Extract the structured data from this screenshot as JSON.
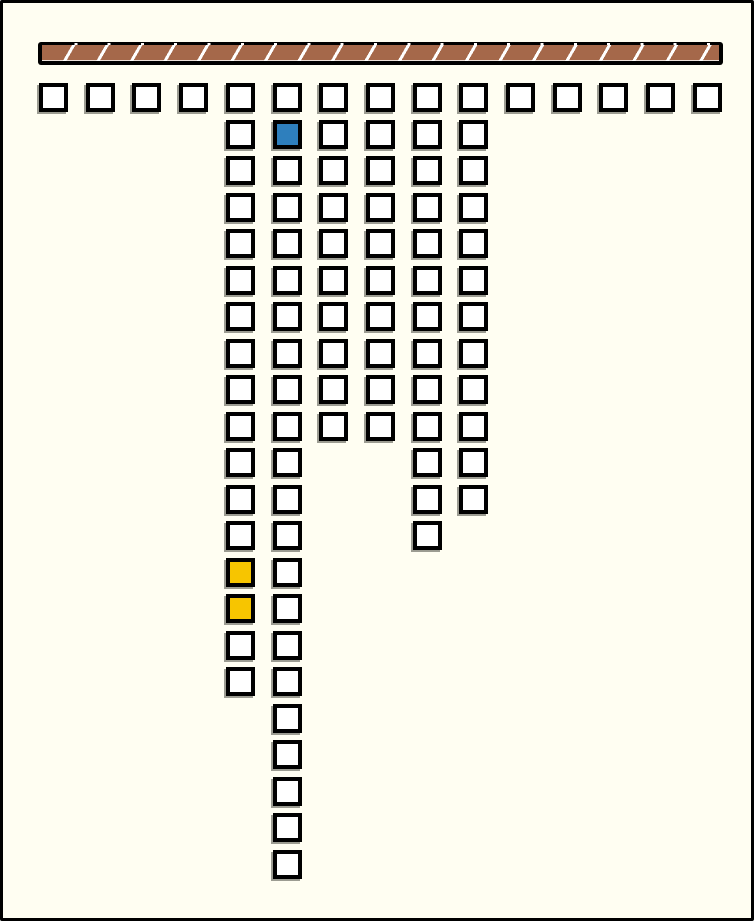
{
  "window": {
    "width": 754,
    "height": 921,
    "background_color": "#FFFEF2",
    "frame_color": "#000000"
  },
  "beam": {
    "x": 35,
    "y": 39,
    "width": 685,
    "height": 23,
    "fill_color": "#A5684A",
    "frame_color": "#000000",
    "stripe_color": "#FFFFFF",
    "stripe_pitch_px": 33.3,
    "stripe_angle_deg": 120
  },
  "board": {
    "origin_x": 36,
    "origin_y": 80,
    "col_pitch": 46.7,
    "row_pitch": 36.5,
    "cell_size_px": 29,
    "cell_border_px": 4,
    "columns": 15,
    "column_depths": [
      1,
      1,
      1,
      1,
      17,
      22,
      10,
      10,
      13,
      12,
      1,
      1,
      1,
      1,
      1
    ],
    "default_cell_color": "#FFFFFF",
    "cell_border_color": "#000000",
    "cell_shadow_color": "#9C9C92",
    "total_cells": 93,
    "highlight_cells": [
      {
        "row": 2,
        "col": 5,
        "color_name": "blue",
        "color": "#2E7FBD"
      },
      {
        "row": 14,
        "col": 4,
        "color_name": "yellow",
        "color": "#F7C500"
      },
      {
        "row": 15,
        "col": 4,
        "color_name": "yellow",
        "color": "#F7C500"
      }
    ]
  }
}
